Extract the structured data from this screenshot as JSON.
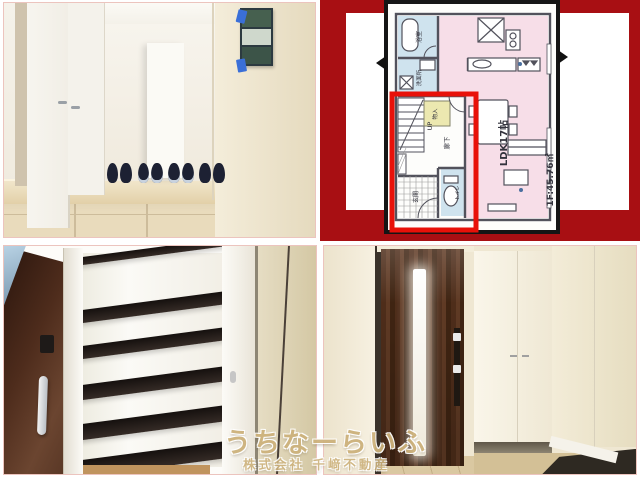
{
  "watermark": {
    "brand": "うちなーらいふ",
    "company": "株式会社 千﨑不動産"
  },
  "floor_plan": {
    "labels": {
      "ldk": "LDK17帖",
      "area": "1F:45.76㎡",
      "up": "UP",
      "hallway": "廊下",
      "bath": "浴室",
      "washroom": "洗面所",
      "entrance": "玄関",
      "toilet": "トイレ",
      "storage": "物入"
    },
    "colors": {
      "background_red": "#a80f13",
      "highlight_red": "#e81109",
      "living_pink": "#f7dee8",
      "wet_area_blue": "#cfe3ee",
      "storage_yellow": "#ece8b0"
    }
  },
  "photos": {
    "top_left": "entrance-hall-with-shoes",
    "bottom_left": "shoe-closet-shelves",
    "bottom_right": "front-door-interior"
  }
}
